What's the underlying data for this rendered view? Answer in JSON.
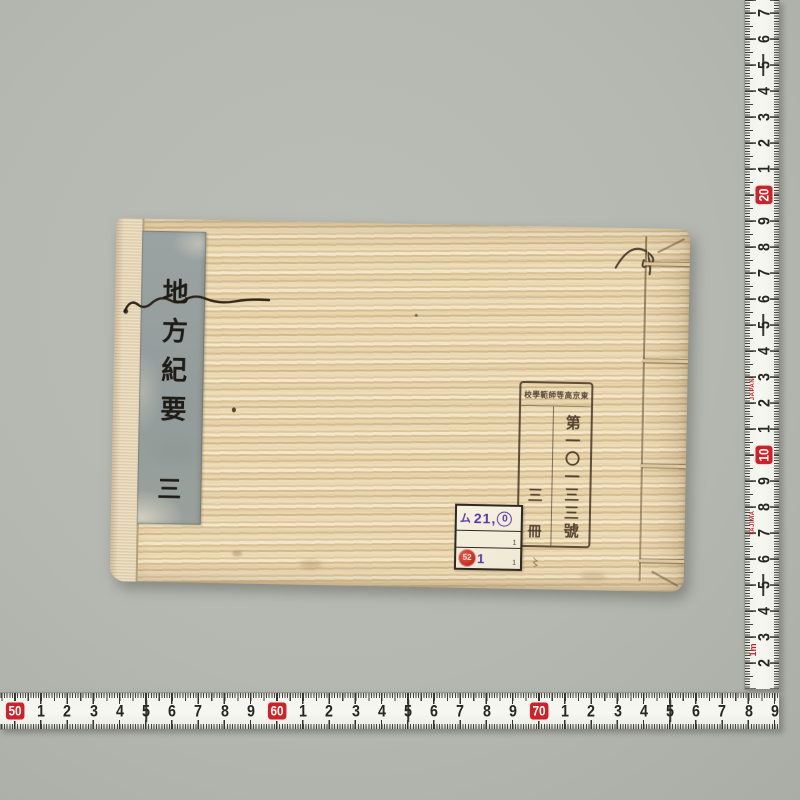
{
  "photo": {
    "background_color": "#b5b8b1",
    "book": {
      "cover_base_color": "#e7d5ae",
      "title_slip": {
        "slip_color": "#97a09f",
        "title": "地方紀要",
        "volume": "三"
      },
      "library_stamp": {
        "header": "東京高等師範學校",
        "number": "第一〇一三三號",
        "volume_count_top": "三",
        "volume_count_bottom": "冊",
        "mark_below": "〻"
      },
      "call_number_label": {
        "row1_prefix": "ム",
        "row1_number": "21,",
        "row1_circled": "0",
        "row2_mark": "1",
        "row3_stamp_number": "52",
        "row3_number": "1",
        "row3_mark": "1"
      }
    },
    "rulers": {
      "tape_red": "#c8242c",
      "vertical": {
        "numbers": [
          {
            "t": "7"
          },
          {
            "t": "6"
          },
          {
            "t": "5"
          },
          {
            "t": "4"
          },
          {
            "t": "3"
          },
          {
            "t": "2"
          },
          {
            "t": "1"
          },
          {
            "t": "20",
            "red": true
          },
          {
            "t": "9"
          },
          {
            "t": "8"
          },
          {
            "t": "7"
          },
          {
            "t": "6"
          },
          {
            "t": "5"
          },
          {
            "t": "4"
          },
          {
            "t": "3"
          },
          {
            "t": "2"
          },
          {
            "t": "1"
          },
          {
            "t": "10",
            "red": true
          },
          {
            "t": "9"
          },
          {
            "t": "8"
          },
          {
            "t": "7"
          },
          {
            "t": "6"
          },
          {
            "t": "5"
          },
          {
            "t": "4"
          },
          {
            "t": "3"
          },
          {
            "t": "2"
          }
        ],
        "brand_marks": [
          {
            "t": "JAPAN",
            "pos": 14.45,
            "cls": ""
          },
          {
            "t": "TAJIMA",
            "pos": 19.6,
            "cls": ""
          },
          {
            "t": "1m",
            "pos": 24.5,
            "cls": "meter"
          }
        ]
      },
      "horizontal": {
        "numbers": [
          {
            "t": "50",
            "red": true
          },
          {
            "t": "1"
          },
          {
            "t": "2"
          },
          {
            "t": "3"
          },
          {
            "t": "4"
          },
          {
            "t": "5"
          },
          {
            "t": "6"
          },
          {
            "t": "7"
          },
          {
            "t": "8"
          },
          {
            "t": "9"
          },
          {
            "t": "60",
            "red": true
          },
          {
            "t": "1"
          },
          {
            "t": "2"
          },
          {
            "t": "3"
          },
          {
            "t": "4"
          },
          {
            "t": "5"
          },
          {
            "t": "6"
          },
          {
            "t": "7"
          },
          {
            "t": "8"
          },
          {
            "t": "9"
          },
          {
            "t": "70",
            "red": true
          },
          {
            "t": "1"
          },
          {
            "t": "2"
          },
          {
            "t": "3"
          },
          {
            "t": "4"
          },
          {
            "t": "5"
          },
          {
            "t": "6"
          },
          {
            "t": "7"
          },
          {
            "t": "8"
          },
          {
            "t": "9"
          }
        ]
      }
    }
  }
}
